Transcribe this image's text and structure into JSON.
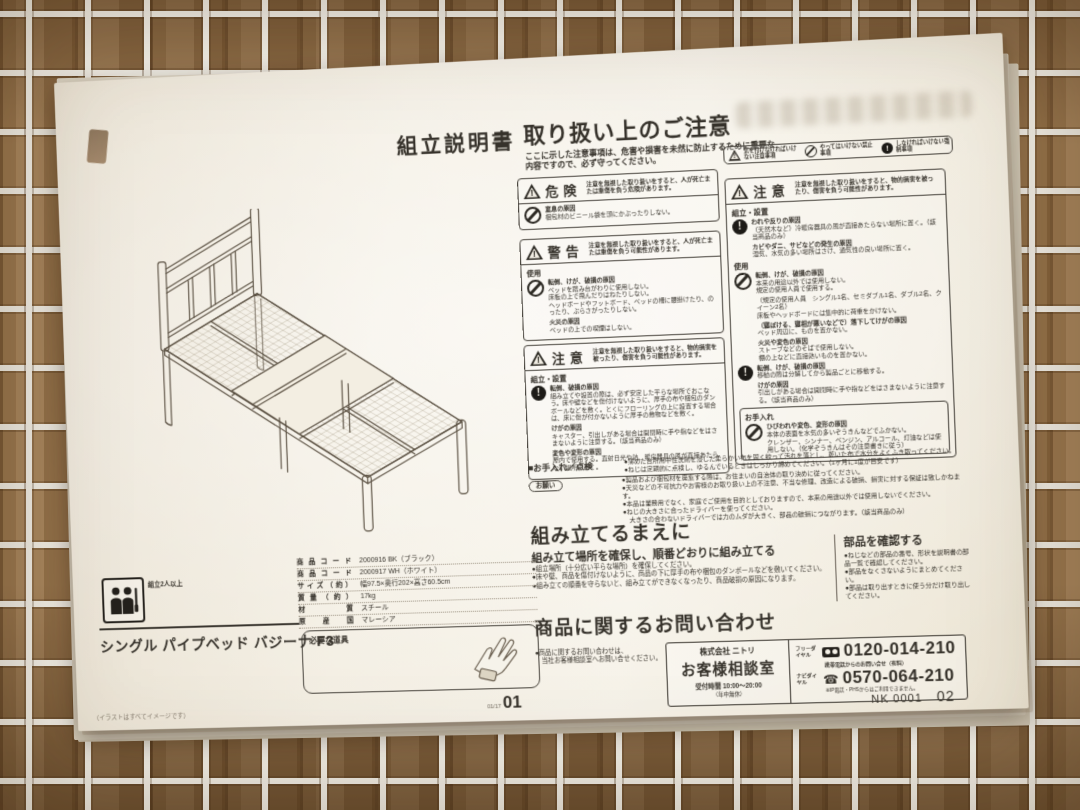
{
  "title": "組立説明書",
  "legend": {
    "items": [
      {
        "label": "気を付けなければいけない注意事項"
      },
      {
        "label": "やってはいけない禁止事項"
      },
      {
        "label": "しなければいけない強制事項"
      }
    ]
  },
  "handling": {
    "heading": "取り扱い上のご注意",
    "intro": "ここに示した注意事項は、危害や損害を未然に防止するために重要な内容ですので、必ず守ってください。",
    "danger": {
      "label": "危険",
      "desc": "注意を無視した取り扱いをすると、人が死亡または重傷を負う危険があります。",
      "cause": "窒息の原因",
      "line": "梱包材のビニール袋を頭にかぶったりしない。"
    },
    "warning": {
      "label": "警告",
      "desc": "注意を無視した取り扱いをすると、人が死亡または重傷を負う可能性があります。",
      "use_h": "使用",
      "cause1": "転倒、けが、破損の原因",
      "l1": "ベッドを踏み台がわりに使用しない。",
      "l2": "床板の上で飛んだりはねたりしない。",
      "l3": "ヘッドボードやフットボード、ベッドの柵に腰掛けたり、のったり、ぶらさがったりしない。",
      "cause2": "火災の原因",
      "l4": "ベッドの上での喫煙はしない。"
    },
    "caution": {
      "label": "注意",
      "desc": "注意を無視した取り扱いをすると、物的損害を被ったり、傷害を負う可能性があります。",
      "setup_h": "組立・設置",
      "cause1": "転倒、破損の原因",
      "l1": "組み立てや設置の際は、必ず安定した平らな場所でおこなう。床や壁などを傷付けないように、厚手の布や梱包のダンボールなどを敷く。とくにフローリングの上に設置する場合は、床に傷が付かないように厚手の敷物などを敷く。",
      "cause2": "けがの原因",
      "l2": "キャスター、引出しがある場合は開閉時に手や指などをはさまないように注意する。（該当商品のみ）",
      "cause3": "変色や変形の原因",
      "l3": "屋内で使用する。直射日光や熱、暖房器具の風が直接あたらない場所に置く。"
    },
    "caution2": {
      "label": "注意",
      "desc": "注意を無視した取り扱いをすると、物的損害を被ったり、傷害を負う可能性があります。",
      "setup_h": "組立・設置",
      "s1c1": "われや反りの原因",
      "s1l1": "（天然木など）冷暖房器具の風が直接あたらない場所に置く。（該当商品のみ）",
      "s1c2": "カビやダニ、サビなどの発生の原因",
      "s1l2": "湿気、水気の多い場所はさけ、通気性の良い場所に置く。",
      "use_h": "使用",
      "u1c": "転倒、けが、破損の原因",
      "u1l1": "本来の用途以外では使用しない。",
      "u1l2": "規定の使用人員で使用する。",
      "u1l3": "（規定の使用人員　シングル1名、セミダブル1名、ダブル2名、クイーン2名）",
      "u1l4": "床板やヘッドボードには集中的に荷重をかけない。",
      "u2c": "（寝ぼける、寝相が悪いなどで）落下してけがの原因",
      "u2l": "ベッド周辺に、ものを置かない。",
      "u3c": "火災や変色の原因",
      "u3l1": "ストーブなどのそばで使用しない。",
      "u3l2": "棚の上などに直接熱いものを置かない。",
      "u4c": "転倒、けが、破損の原因",
      "u4l": "移動の際は分解してから製品ごとに移動する。",
      "u5c": "けがの原因",
      "u5l": "引出しがある場合は開閉時に手や指などをはさまないように注意する。（該当商品のみ）",
      "care_h": "お手入れ",
      "c1c": "ひびわれや変色、変形の原因",
      "c1l1": "本体の表面を水気の多いぞうきんなどでふかない。",
      "c1l2": "クレンザー、シンナー、ベンジン、アルコール、灯油などは使用しない。（化学ぞうきんはその注意書きに従う）"
    }
  },
  "maintenance": {
    "label": "■お手入れ／点検",
    "item1": "●薄めた台所用中性洗剤を浸した柔らかい布を固く絞って汚れを落とし、乾いた布で水分をよくふき取ってください。",
    "item2": "●ねじは定期的に点検し、ゆるんでいるときはしっかり締めてください。（1ヶ月に1度が目安です）",
    "request_label": "お願い",
    "r1": "●製品および梱包材を廃棄する際は、お住まいの自治体の取り決めに従ってください。",
    "r2": "●天災などの不可抗力やお客様のお取り扱い上の不注意、不当な修理、改造による破損、損害に対する保証は致しかねます。",
    "r3": "●本品は業務用でなく、家庭でご使用を目的としておりますので、本来の用途以外では使用しないでください。",
    "r4": "●ねじの大きさに合ったドライバーを使ってください。",
    "r5": "　大きさの合わないドライバーでは力のムダが大きく、部品の破損につながります。（該当商品のみ）"
  },
  "before": {
    "heading": "組み立てるまえに",
    "sub": "組み立て場所を確保し、順番どおりに組み立てる",
    "i1": "●組立場所（十分広い平らな場所）を確保してください。",
    "i2": "●床や壁、商品を傷付けないように、商品の下に厚手の布や梱包のダンボールなどを敷いてください。",
    "i3": "●組み立ての順番を守らないと、組み立てができなくなったり、商品破損の原因になります。",
    "parts_heading": "部品を確認する",
    "p1": "●ねじなどの部品の番号、形状を説明書の部品一覧で確認してください。",
    "p2": "●部品をなくさないようにまとめてください。",
    "p3": "●部品は取り出すときに使う分だけ取り出してください。"
  },
  "inquiry": {
    "heading": "商品に関するお問い合わせ",
    "note1": "●商品に関するお問い合わせは、",
    "note2": "　当社お客様相談室へお問い合せください。",
    "company": "株式会社 ニトリ",
    "office": "お客様相談室",
    "hours": "受付時間 10:00～20:00",
    "hours_note": "（年中無休）",
    "free_label": "フリーダイヤル",
    "free_number": "0120-014-210",
    "mobile_note": "携帯電話からのお問い合せ（有料）",
    "navi_label": "ナビダイヤル",
    "navi_number": "0570-064-210",
    "navi_note": "※IP電話・PHSからはご利用できません。"
  },
  "product": {
    "name": "シングル パイプベッド バジーナ F3",
    "assembly_note": "組立2人以上",
    "table": [
      [
        "商品コード",
        "2000916 BK（ブラック）"
      ],
      [
        "商品コード",
        "2000917 WH（ホワイト）"
      ],
      [
        "サイズ（約）",
        "幅97.5×奥行202×高さ60.5cm"
      ],
      [
        "質量（約）",
        "17kg"
      ],
      [
        "材質",
        "スチール"
      ],
      [
        "原産国",
        "マレーシア"
      ]
    ],
    "tools_label": "必要な道具",
    "illustration_note": "（イラストはすべてイメージです）",
    "page_small": "01/17",
    "page_big": "01"
  },
  "footer": {
    "code": "NK 0001",
    "num": "02"
  },
  "colors": {
    "paper": "#f2ecdf",
    "ink": "#36322b",
    "wood": "#96744c",
    "accent_white_wire": "#f1eee6"
  }
}
